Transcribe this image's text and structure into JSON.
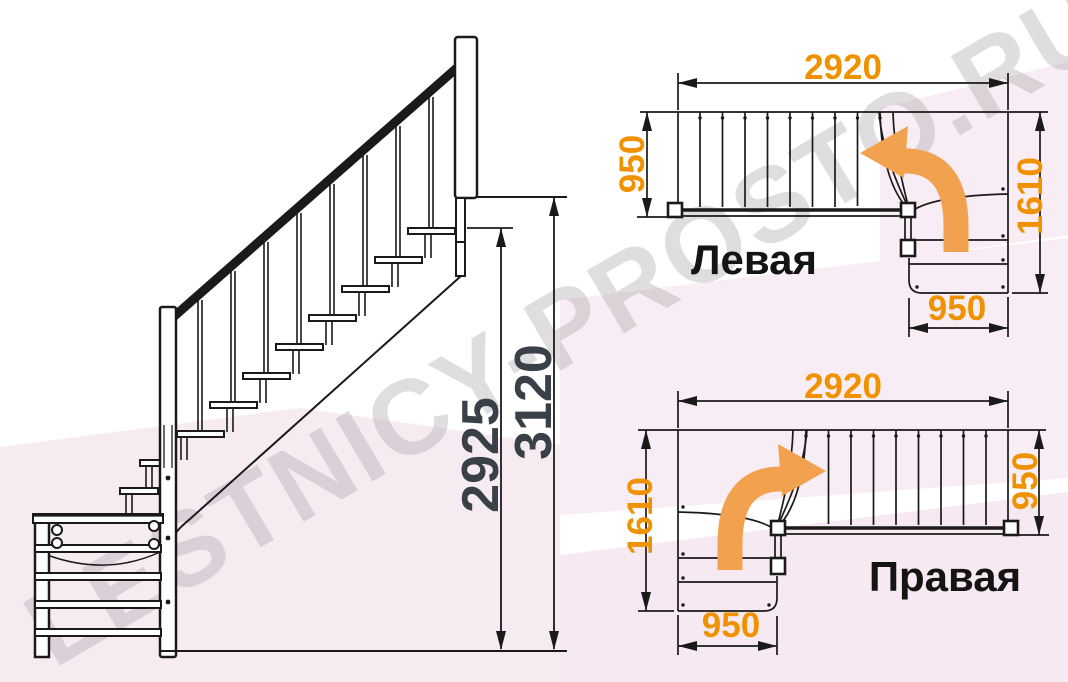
{
  "title": "Чертёж лестницы с поворотом",
  "watermark": {
    "text": "LESTNICY-PROSTO.RU"
  },
  "side_view": {
    "dim_height_to_top_step": "2925",
    "dim_height_total": "3120"
  },
  "plans": {
    "left": {
      "label": "Левая",
      "dim_length": "2920",
      "dim_flight_width": "950",
      "dim_turn_depth": "1610",
      "dim_turn_width": "950",
      "turn_arrow_icon": "turn-left-arrow"
    },
    "right": {
      "label": "Правая",
      "dim_length": "2920",
      "dim_flight_width": "950",
      "dim_turn_depth": "1610",
      "dim_turn_width": "950",
      "turn_arrow_icon": "turn-right-arrow"
    }
  },
  "colors": {
    "dimension_orange": "#F09200",
    "arrow_orange": "#F2A24E",
    "drawing_line": "#1A1A1A",
    "side_dimension_text": "#3A4047",
    "background_pink": "#F7EBF2",
    "watermark_gray": "#ACA6AC"
  }
}
